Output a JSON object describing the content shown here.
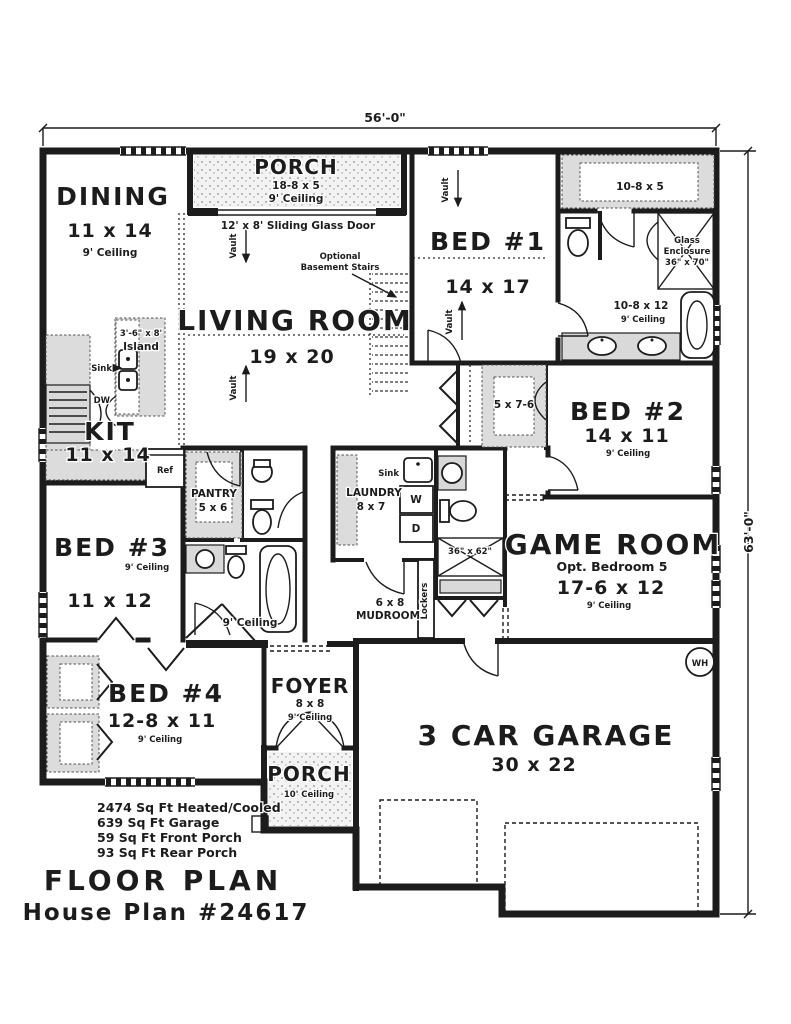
{
  "meta": {
    "title": "FLOOR PLAN",
    "plan": "House Plan #24617"
  },
  "dimensions": {
    "width": "56'-0\"",
    "height": "63'-0\""
  },
  "areas": {
    "heated": "2474 Sq Ft Heated/Cooled",
    "garage": "639 Sq Ft Garage",
    "front_porch": "59 Sq Ft Front Porch",
    "rear_porch": "93 Sq Ft Rear Porch"
  },
  "rooms": {
    "rear_porch": {
      "name": "PORCH",
      "size": "18-8 x 5",
      "ceiling": "9' Ceiling"
    },
    "dining": {
      "name": "DINING",
      "size": "11 x 14",
      "ceiling": "9' Ceiling"
    },
    "living": {
      "name": "LIVING ROOM",
      "size": "19 x 20"
    },
    "kitchen": {
      "name": "KIT",
      "size": "11 x 14"
    },
    "bed1": {
      "name": "BED #1",
      "size": "14 x 17"
    },
    "bed1_closet": {
      "size": "10-8 x 5"
    },
    "master_bath": {
      "size": "10-8 x 12",
      "ceiling": "9' Ceiling"
    },
    "glass_enclosure": {
      "l1": "Glass",
      "l2": "Enclosure",
      "l3": "36\" x 70\""
    },
    "bed2": {
      "name": "BED #2",
      "size": "14 x 11",
      "ceiling": "9' Ceiling"
    },
    "bed2_closet": {
      "size": "5 x 7-6"
    },
    "bed3": {
      "name": "BED #3",
      "size": "11 x 12",
      "ceiling": "9' Ceiling"
    },
    "bed4": {
      "name": "BED #4",
      "size": "12-8 x 11",
      "ceiling": "9' Ceiling"
    },
    "pantry": {
      "name": "PANTRY",
      "size": "5 x 6"
    },
    "laundry": {
      "name": "LAUNDRY",
      "size": "8 x 7"
    },
    "mudroom": {
      "size": "6 x 8",
      "name": "MUDROOM"
    },
    "game_room": {
      "name": "GAME ROOM",
      "alt": "Opt. Bedroom 5",
      "size": "17-6 x 12",
      "ceiling": "9' Ceiling"
    },
    "foyer": {
      "name": "FOYER",
      "size": "8 x 8",
      "ceiling": "9' Ceiling"
    },
    "front_porch": {
      "name": "PORCH",
      "ceiling": "10' Ceiling"
    },
    "garage": {
      "name": "3 CAR GARAGE",
      "size": "30 x 22"
    },
    "hall": {
      "ceiling": "9' Ceiling"
    }
  },
  "labels": {
    "sliding_door": "12' x 8' Sliding Glass Door",
    "optional": "Optional",
    "basement_stairs": "Basement Stairs",
    "island_size": "3'-6\" x 8'",
    "island": "Island",
    "sink": "Sink",
    "dw": "DW",
    "ref": "Ref",
    "washer": "W",
    "dryer": "D",
    "lockers": "Lockers",
    "shower_size": "36\" x 62\"",
    "vault": "Vault",
    "water_heater": "WH"
  }
}
